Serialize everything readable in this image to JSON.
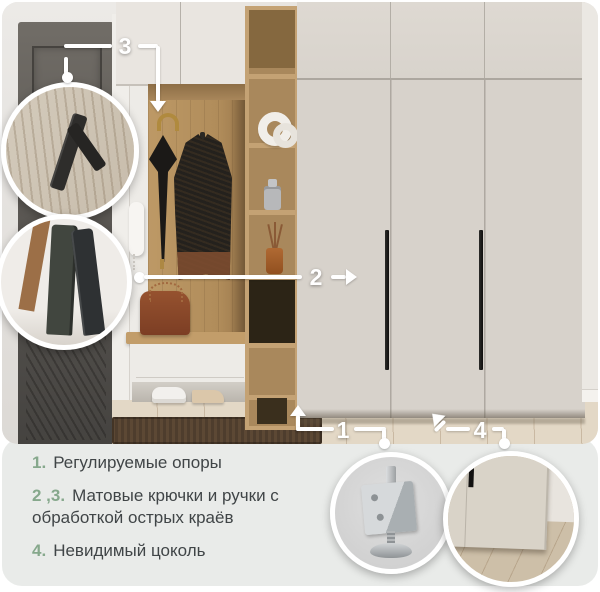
{
  "annotations": {
    "marker1": "1",
    "marker2": "2",
    "marker3": "3",
    "marker4": "4"
  },
  "legend": {
    "items": [
      {
        "number": "1.",
        "text": "Регулируемые опоры"
      },
      {
        "number": "2 ,3.",
        "text": "Матовые крючки и ручки с обработкой острых краёв"
      },
      {
        "number": "4.",
        "text": "Невидимый цоколь"
      }
    ]
  },
  "insets": {
    "hook_closeup": "black-hook-closeup",
    "handle_closeup": "matte-handle-edge-closeup",
    "foot_closeup": "adjustable-foot-closeup",
    "plinth_closeup": "invisible-plinth-closeup"
  },
  "colors": {
    "accent_green": "#86a88c",
    "text": "#404547",
    "panel_bg": "#e9ebe9",
    "marker_white": "#ffffff",
    "wardrobe_door": "#d7d2cb",
    "oak_wood": "#b6935f",
    "interior_door": "#56534f"
  }
}
